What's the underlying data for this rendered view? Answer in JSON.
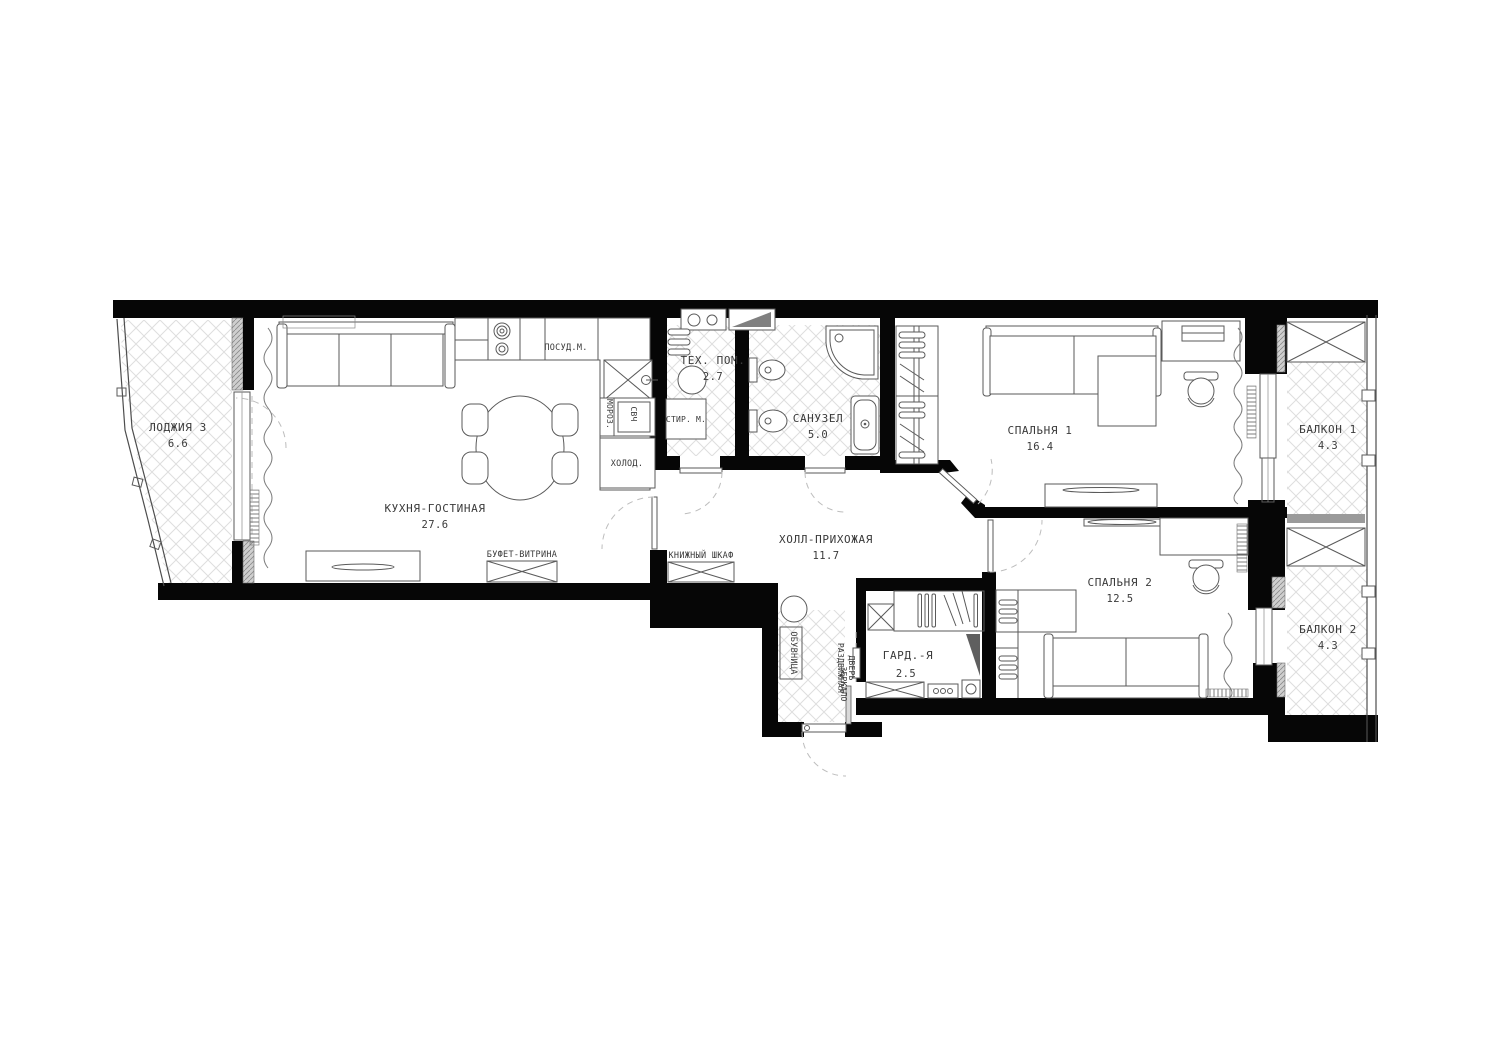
{
  "plan": {
    "rooms": [
      {
        "id": "loggia3",
        "name": "ЛОДЖИЯ 3",
        "area": "6.6"
      },
      {
        "id": "kitchen",
        "name": "КУХНЯ-ГОСТИНАЯ",
        "area": "27.6"
      },
      {
        "id": "tech",
        "name": "ТЕХ. ПОМ.",
        "area": "2.7"
      },
      {
        "id": "bath",
        "name": "САНУЗЕЛ",
        "area": "5.0"
      },
      {
        "id": "bedroom1",
        "name": "СПАЛЬНЯ 1",
        "area": "16.4"
      },
      {
        "id": "balcony1",
        "name": "БАЛКОН 1",
        "area": "4.3"
      },
      {
        "id": "hall",
        "name": "ХОЛЛ-ПРИХОЖАЯ",
        "area": "11.7"
      },
      {
        "id": "wardrobe",
        "name": "ГАРД.-Я",
        "area": "2.5"
      },
      {
        "id": "bedroom2",
        "name": "СПАЛЬНЯ 2",
        "area": "12.5"
      },
      {
        "id": "balcony2",
        "name": "БАЛКОН 2",
        "area": "4.3"
      }
    ],
    "fixtures": {
      "dishwasher": "ПОСУД.М.",
      "freezer": "МОРОЗ.",
      "microwave": "СВЧ",
      "fridge": "ХОЛОД.",
      "washer": "СТИР. М.",
      "buffet": "БУФЕТ-ВИТРИНА",
      "bookcase": "КНИЖНЫЙ ШКАФ",
      "shoe_cabinet": "ОБУВНИЦА",
      "sliding_door_line1": "РАЗДВИЖНАЯ",
      "sliding_door_line2": "ДВЕРЬ",
      "mirror": "ЗЕРКАЛО"
    },
    "colors": {
      "wall": "#060606",
      "line": "#5a5a5a",
      "tile": "#dedede",
      "text": "#3a3a3a"
    }
  }
}
